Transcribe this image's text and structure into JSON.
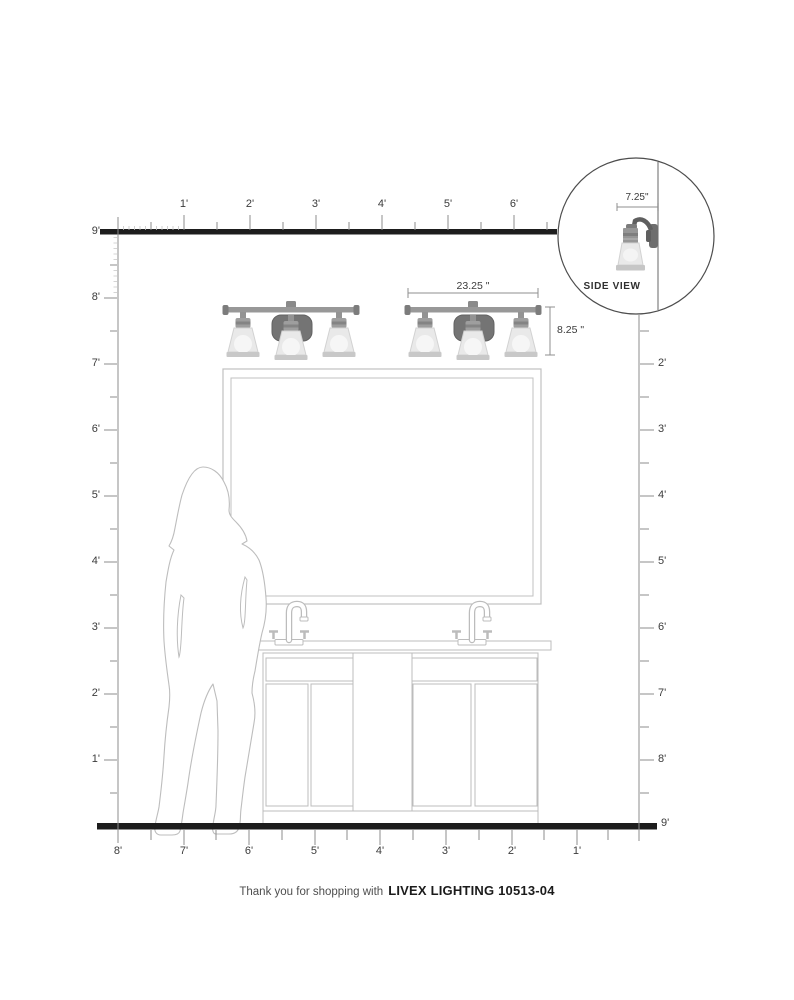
{
  "rulers": {
    "top": {
      "labels": [
        "1'",
        "2'",
        "3'",
        "4'",
        "5'",
        "6'"
      ]
    },
    "left": {
      "labels": [
        "9'",
        "8'",
        "7'",
        "6'",
        "5'",
        "4'",
        "3'",
        "2'",
        "1'"
      ]
    },
    "right": {
      "labels": [
        "2'",
        "3'",
        "4'",
        "5'",
        "6'",
        "7'",
        "8'",
        "9'"
      ]
    },
    "bottom": {
      "labels": [
        "8'",
        "7'",
        "6'",
        "5'",
        "4'",
        "3'",
        "2'",
        "1'"
      ]
    }
  },
  "fixture": {
    "width_dimension": "23.25 \"",
    "height_dimension": "8.25 \"",
    "side_view": {
      "label": "SIDE VIEW",
      "depth_dimension": "7.25\""
    }
  },
  "footer": {
    "prefix": "Thank you for shopping with",
    "product": "LIVEX LIGHTING 10513-04"
  },
  "colors": {
    "structural_line": "#1d1d1d",
    "ruler_line": "#8c8c8c",
    "fine_tick": "#c6c6c6",
    "drawing_outline": "#bcbcbc",
    "fixture_metal": "#8f8f8f",
    "fixture_backplate": "#747474",
    "fixture_shade": "#e9e9e9",
    "text": "#3b3b3b"
  }
}
